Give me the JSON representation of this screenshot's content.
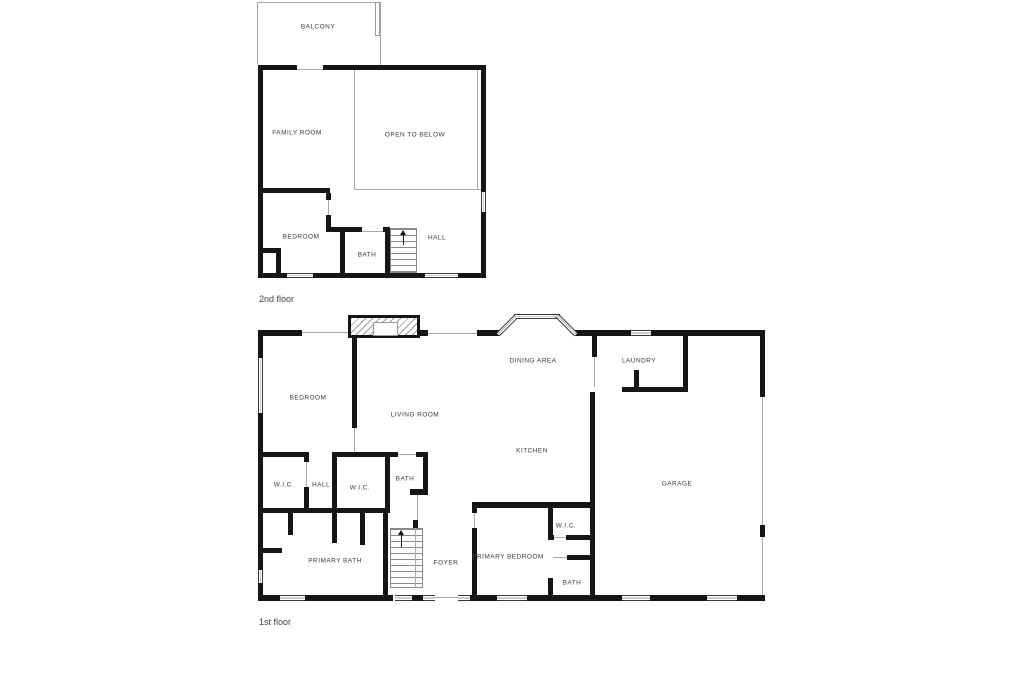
{
  "floor_plan": {
    "floors": [
      {
        "caption": "2nd floor",
        "rooms": [
          "BALCONY",
          "FAMILY ROOM",
          "OPEN TO BELOW",
          "BEDROOM",
          "BATH",
          "HALL"
        ]
      },
      {
        "caption": "1st floor",
        "rooms": [
          "DINING AREA",
          "LAUNDRY",
          "BEDROOM",
          "LIVING ROOM",
          "KITCHEN",
          "GARAGE",
          "W.I.C.",
          "HALL",
          "W.I.C.",
          "BATH",
          "PRIMARY BATH",
          "FOYER",
          "PRIMARY BEDROOM",
          "W.I.C.",
          "BATH"
        ]
      }
    ],
    "colors": {
      "wall": "#161616",
      "thin_line": "#a9a9a9",
      "label": "#3a3a3a",
      "background": "#ffffff"
    }
  }
}
